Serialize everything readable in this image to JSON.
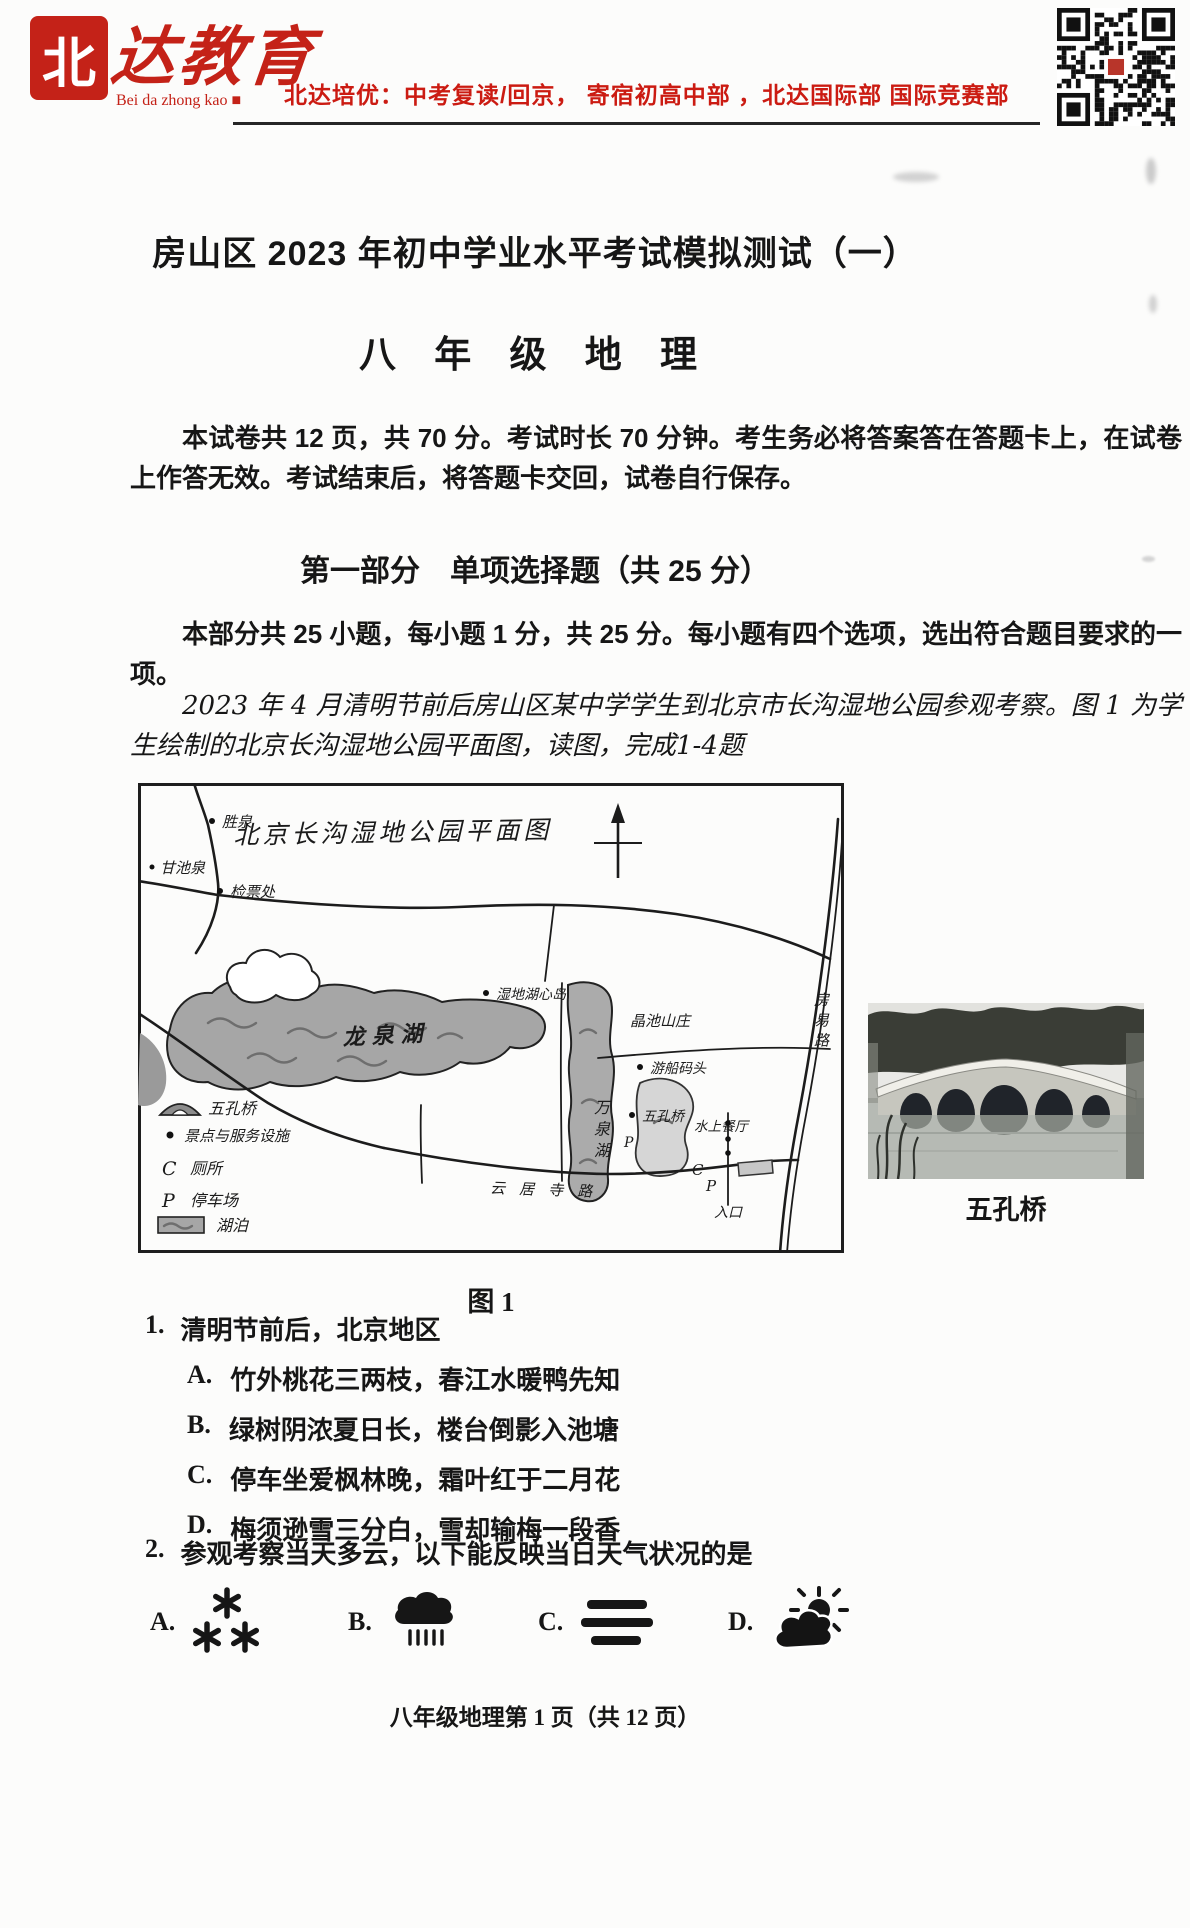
{
  "header": {
    "logo": {
      "seal_char": "北",
      "script_text": "达教育",
      "subtext": "Bei da zhong kao ■"
    },
    "slogan": "北达培优：中考复读/回京， 寄宿初高中部 ，北达国际部 国际竞赛部",
    "accent_color": "#c42218"
  },
  "title": "房山区 2023 年初中学业水平考试模拟测试（一）",
  "subtitle": "八 年 级 地 理",
  "intro": {
    "p1": "本试卷共 12 页，共 70 分。考试时长 70 分钟。考生务必将答案答在答题卡上，在试卷上作答无效。考试结束后，将答题卡交回，试卷自行保存。",
    "section_heading": "第一部分　单项选择题（共 25 分）",
    "p2": "本部分共 25 小题，每小题 1 分，共 25 分。每小题有四个选项，选出符合题目要求的一项。",
    "p3": "2023 年 4 月清明节前后房山区某中学学生到北京市长沟湿地公园参观考察。图 1 为学生绘制的北京长沟湿地公园平面图，读图，完成1-4题"
  },
  "figure": {
    "map": {
      "title": "北京长沟湿地公园平面图",
      "caption": "图 1",
      "labels": {
        "shengquan": "胜泉",
        "ganchiquan": "甘池泉",
        "jianpiao": "检票处",
        "longquanhu": "龙泉湖",
        "huxindao": "湿地湖心岛",
        "shanzhuang": "晶池山庄",
        "wanquanhu": "万泉湖",
        "youchuan": "游船码头",
        "wukongqiao": "五孔桥",
        "shuishang": "水上餐厅",
        "cmark": "C",
        "pmark": "P",
        "pmark2": "P",
        "rukou": "入口",
        "fangyilu": "房易路",
        "yunjusilu": "云居寺路"
      },
      "legend": [
        {
          "icon": "bridge",
          "label": "五孔桥"
        },
        {
          "icon": "dot",
          "label": "景点与服务设施"
        },
        {
          "icon": "C",
          "label": "厕所"
        },
        {
          "icon": "P",
          "label": "停车场"
        },
        {
          "icon": "lake",
          "label": "湖泊"
        }
      ]
    },
    "photo": {
      "caption": "五孔桥"
    }
  },
  "questions": {
    "q1": {
      "number": "1.",
      "stem": "清明节前后，北京地区",
      "options": [
        {
          "key": "A.",
          "text": "竹外桃花三两枝，春江水暖鸭先知"
        },
        {
          "key": "B.",
          "text": "绿树阴浓夏日长，楼台倒影入池塘"
        },
        {
          "key": "C.",
          "text": "停车坐爱枫林晚，霜叶红于二月花"
        },
        {
          "key": "D.",
          "text": "梅须逊雪三分白，雪却输梅一段香"
        }
      ]
    },
    "q2": {
      "number": "2.",
      "stem": "参观考察当天多云，以下能反映当日天气状况的是",
      "options": [
        {
          "key": "A.",
          "symbol": "snow"
        },
        {
          "key": "B.",
          "symbol": "rain"
        },
        {
          "key": "C.",
          "symbol": "fog"
        },
        {
          "key": "D.",
          "symbol": "partly-cloudy"
        }
      ]
    }
  },
  "footer": "八年级地理第 1 页（共 12 页）"
}
